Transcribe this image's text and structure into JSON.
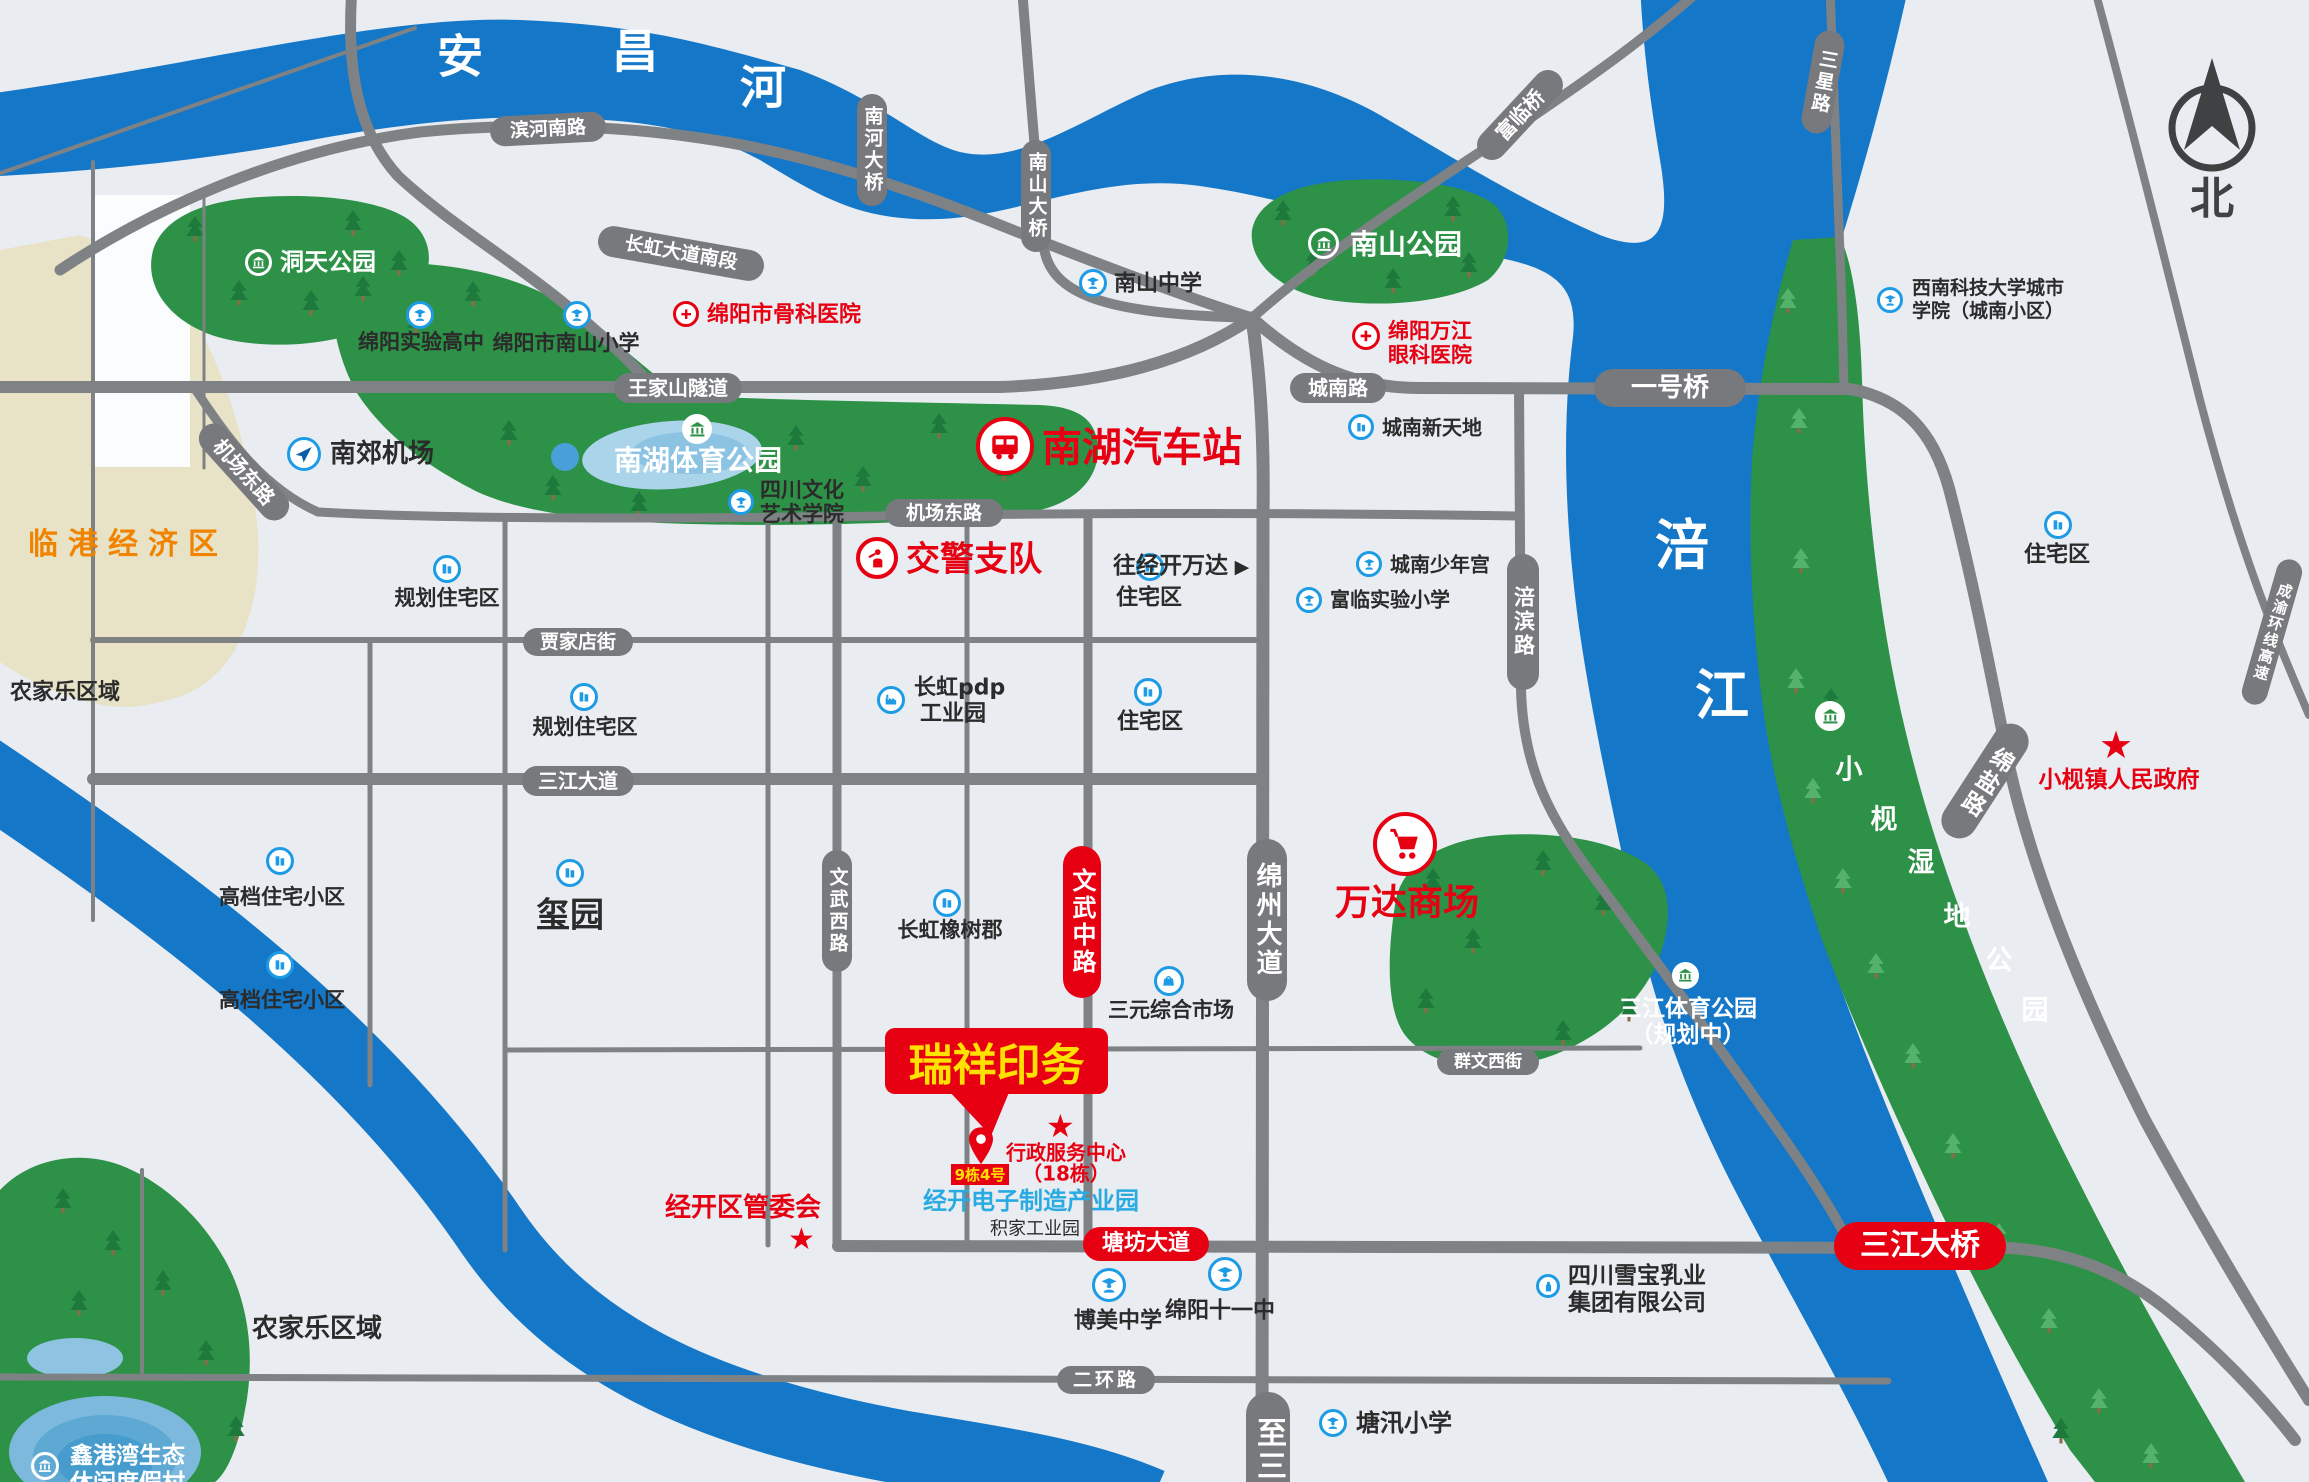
{
  "compass": {
    "north_label": "北"
  },
  "rivers": {
    "anchang_chars": [
      "安",
      "昌",
      "河"
    ],
    "fujiang_chars": [
      "涪",
      "江"
    ]
  },
  "roads": {
    "binhe_south": "滨河南路",
    "changhong_south": "长虹大道南段",
    "wangjiashan_tunnel": "王家山隧道",
    "chengnan": "城南路",
    "jichang_east": "机场东路",
    "jiajiadian": "贾家店街",
    "sanjiang_avenue": "三江大道",
    "bridge_no1": "一号桥",
    "fulin_bridge": "富临桥",
    "sanxing": "三星路",
    "nanhe_bridge": "南河大桥",
    "nanshan_bridge": "南山大桥",
    "fubin": "涪滨路",
    "mianzhou_avenue": "绵州大道",
    "wenwu_west": "文武西路",
    "wenwu_middle": "文武中路",
    "qunwen_west": "群文西街",
    "tangfang_avenue": "塘坊大道",
    "erhuan": "二环路",
    "to_santai": "至三",
    "mianyan": "绵盐路",
    "chengyu_expressway": "成渝环线高速",
    "sanjiang_bridge": "三江大桥"
  },
  "zones": {
    "lingang": "临港经济区",
    "nongjiale": "农家乐区域"
  },
  "parks": {
    "dongtian": "洞天公园",
    "nanshan": "南山公园",
    "nanhu_sports": "南湖体育公园",
    "sanjiang_sports_l1": "三江体育公园",
    "sanjiang_sports_l2": "（规划中）",
    "xiaojian_wetland_chars": [
      "小",
      "枧",
      "湿",
      "地",
      "公",
      "园"
    ],
    "xingangwan_l1": "鑫港湾生态",
    "xingangwan_l2": "休闲度假村"
  },
  "places": {
    "shiyan_gaozhong": "绵阳实验高中",
    "nanshan_xiaoxue": "绵阳市南山小学",
    "guke_yiyuan": "绵阳市骨科医院",
    "nanshan_zhongxue": "南山中学",
    "wanjiang_l1": "绵阳万江",
    "wanjiang_l2": "眼科医院",
    "swust_l1": "西南科技大学城市",
    "swust_l2": "学院（城南小区）",
    "nanjiao_airport": "南郊机场",
    "sichuan_culture_l1": "四川文化",
    "sichuan_culture_l2": "艺术学院",
    "nanhu_bus_station": "南湖汽车站",
    "jiaojing": "交警支队",
    "guihua_zhuzhai": "规划住宅区",
    "zhuzhai": "住宅区",
    "chengnan_xintiandi": "城南新天地",
    "chengnan_shaoniangong": "城南少年宫",
    "fulin_xiaoxue": "富临实验小学",
    "changhong_pdp_l1": "长虹pdp",
    "changhong_pdp_l2": "工业园",
    "gaodang_xiaoqu": "高档住宅小区",
    "xiyuan": "玺园",
    "changhong_oak": "长虹橡树郡",
    "wang_jingkai_wanda": "往经开万达",
    "wanda_mall": "万达商场",
    "sanyuan_market": "三元综合市场",
    "bomei_zhongxue": "博美中学",
    "mianyang_11": "绵阳十一中",
    "tangxun_xiaoxue": "塘汛小学",
    "xuebao_l1": "四川雪宝乳业",
    "xuebao_l2": "集团有限公司",
    "xiaojian_gov": "小枧镇人民政府"
  },
  "highlight": {
    "company": "瑞祥印务",
    "address_tag": "9栋4号",
    "admin_center_l1": "行政服务中心",
    "admin_center_l2": "（18栋）",
    "industry_park": "经开电子制造产业园",
    "jijia_park": "积家工业园",
    "management_committee": "经开区管委会"
  },
  "colors": {
    "river": "#1577c8",
    "park": "#2d9147",
    "road": "#7f8285",
    "pill_gray": "#77797c",
    "accent_red": "#e60012",
    "icon_blue": "#1e9be5",
    "highlight_yellow": "#ffe100",
    "zone_beige": "#e8e3c6",
    "zone_orange": "#f08300",
    "background": "#e9ecf1",
    "text_blue": "#29abe2"
  }
}
